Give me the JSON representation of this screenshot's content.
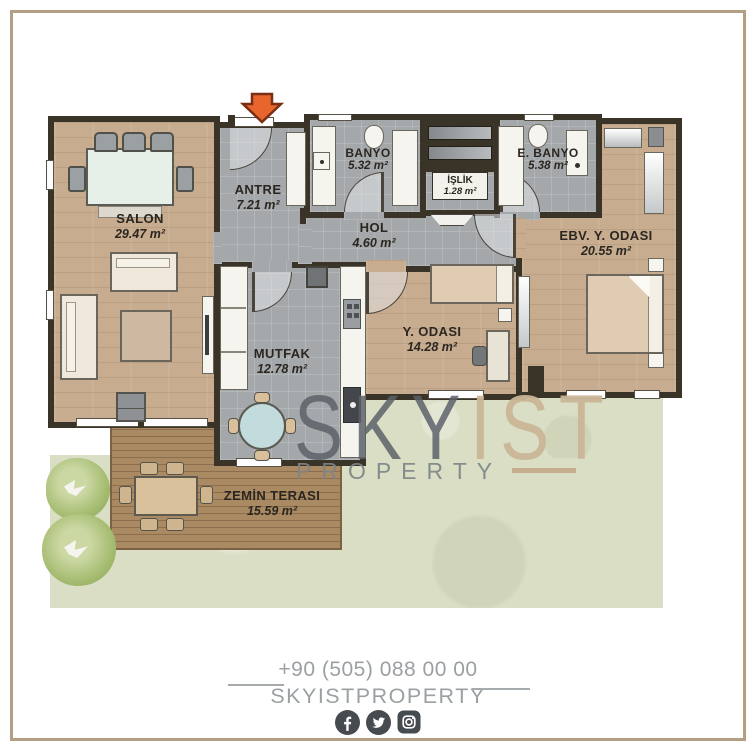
{
  "plan": {
    "rooms": [
      {
        "id": "salon",
        "name": "SALON",
        "area": "29.47 m²"
      },
      {
        "id": "antre",
        "name": "ANTRE",
        "area": "7.21 m²"
      },
      {
        "id": "banyo",
        "name": "BANYO",
        "area": "5.32 m²"
      },
      {
        "id": "islik",
        "name": "İŞLİK",
        "area": "1.28 m²"
      },
      {
        "id": "e_banyo",
        "name": "E. BANYO",
        "area": "5.38 m²"
      },
      {
        "id": "hol",
        "name": "HOL",
        "area": "4.60 m²"
      },
      {
        "id": "ebv_y_odasi",
        "name": "EBV. Y. ODASI",
        "area": "20.55 m²"
      },
      {
        "id": "y_odasi",
        "name": "Y. ODASI",
        "area": "14.28 m²"
      },
      {
        "id": "mutfak",
        "name": "MUTFAK",
        "area": "12.78 m²"
      },
      {
        "id": "zemin_terasi",
        "name": "ZEMİN TERASI",
        "area": "15.59 m²"
      }
    ],
    "entrance_arrow_color": "#e8652e"
  },
  "watermark": {
    "part1": "SKY",
    "part2": "IST",
    "subtitle": "PROPERTY"
  },
  "footer": {
    "phone": "+90 (505) 088 00 00",
    "brand": "SKYISTPROPERTY",
    "social": [
      "facebook-icon",
      "twitter-icon",
      "instagram-icon"
    ]
  },
  "colors": {
    "frame": "#b3a084",
    "wall": "#3a3328",
    "wood_floor": "#c7ac8f",
    "tile_floor": "#a5a8aa",
    "deck": "#aa8a63",
    "garden": "#d9dec4",
    "tree": "#a3bd6d",
    "label": "#2b2620",
    "watermark_gray": "#5c6268",
    "watermark_tan": "#c9b597",
    "footer_text": "#9ba0a3",
    "icon": "#464b50"
  }
}
